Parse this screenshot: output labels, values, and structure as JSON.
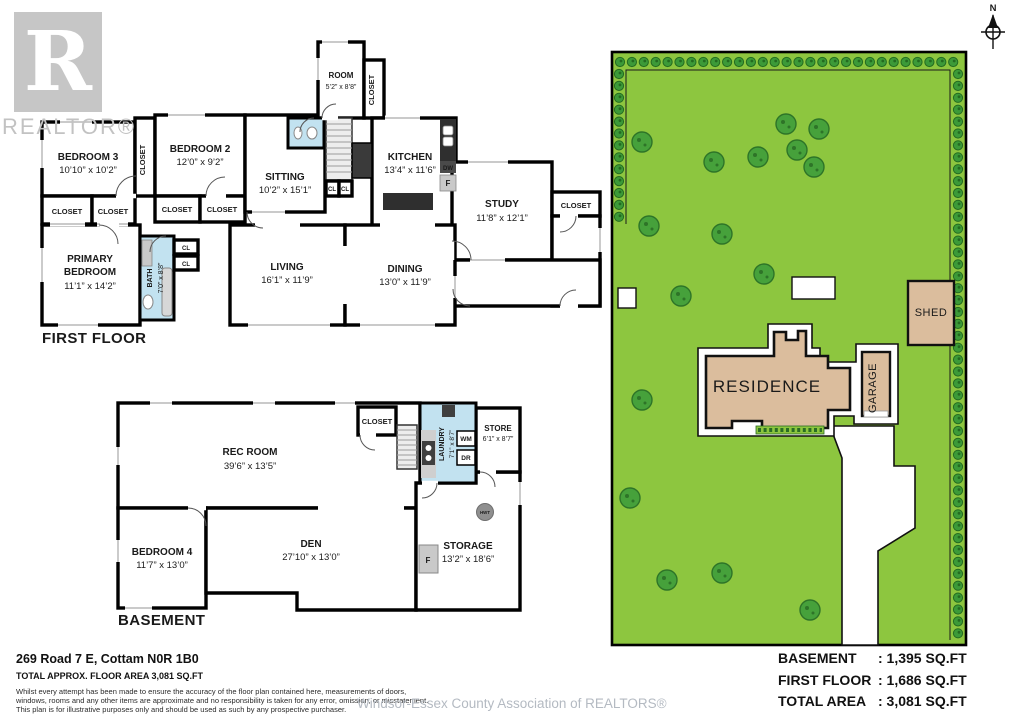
{
  "watermarks": {
    "logo_letter": "R",
    "logo_caption": "REALTOR®",
    "association": "Windsor-Essex County Association of REALTORS®"
  },
  "compass": {
    "label": "N"
  },
  "site": {
    "residence_label": "RESIDENCE",
    "garage_label": "GARAGE",
    "shed_label": "SHED",
    "colors": {
      "lot": "#8DC63F",
      "tree": "#46A13B",
      "hedge": "#3C9A38",
      "building": "#DBBD9D"
    },
    "trees": [
      [
        642,
        142
      ],
      [
        714,
        162
      ],
      [
        758,
        157
      ],
      [
        786,
        124
      ],
      [
        819,
        129
      ],
      [
        797,
        150
      ],
      [
        814,
        167
      ],
      [
        649,
        226
      ],
      [
        722,
        234
      ],
      [
        764,
        274
      ],
      [
        681,
        296
      ],
      [
        642,
        400
      ],
      [
        630,
        498
      ],
      [
        667,
        580
      ],
      [
        722,
        573
      ],
      [
        810,
        610
      ]
    ],
    "hedgerows": [
      {
        "x": 620,
        "y": 62,
        "dx": 11.9,
        "dy": 0,
        "count": 29
      },
      {
        "x": 958,
        "y": 74,
        "dx": 0,
        "dy": 11.9,
        "count": 48
      },
      {
        "x": 619,
        "y": 74,
        "dx": 0,
        "dy": 11.9,
        "count": 13
      }
    ]
  },
  "first_floor": {
    "plan_label": "FIRST FLOOR",
    "bedroom3": {
      "name": "BEDROOM 3",
      "dims": "10’10” x 10’2”"
    },
    "bedroom2": {
      "name": "BEDROOM 2",
      "dims": "12’0” x 9’2”"
    },
    "sitting": {
      "name": "SITTING",
      "dims": "10’2” x 15’1”"
    },
    "room": {
      "name": "ROOM",
      "dims": "5’2” x 8’8”"
    },
    "kitchen": {
      "name": "KITCHEN",
      "dims": "13’4” x 11’6”"
    },
    "study": {
      "name": "STUDY",
      "dims": "11’8” x 12’1”"
    },
    "living": {
      "name": "LIVING",
      "dims": "16’1” x 11’9”"
    },
    "dining": {
      "name": "DINING",
      "dims": "13’0” x 11’9”"
    },
    "primary": {
      "line1": "PRIMARY",
      "line2": "BEDROOM",
      "dims": "11’1” x 14’2”"
    },
    "bath": {
      "name": "BATH",
      "dims": "7’0” x 8’8”"
    },
    "closet": "CLOSET",
    "cl": "CL",
    "dw": "DW",
    "fridge": "F"
  },
  "basement": {
    "plan_label": "BASEMENT",
    "rec": {
      "name": "REC ROOM",
      "dims": "39’6” x 13’5”"
    },
    "bedroom4": {
      "name": "BEDROOM 4",
      "dims": "11’7” x 13’0”"
    },
    "den": {
      "name": "DEN",
      "dims": "27’10” x 13’0”"
    },
    "storage": {
      "name": "STORAGE",
      "dims": "13’2” x 18’6”"
    },
    "laundry": {
      "name": "LAUNDRY",
      "dims": "7’1” x 8’7”"
    },
    "store": {
      "name": "STORE",
      "dims": "6’1” x 8’7”"
    },
    "closet": "CLOSET",
    "wm": "WM",
    "dr": "DR",
    "fridge": "F",
    "hwt": "HWT"
  },
  "footer": {
    "address": "269 Road 7 E, Cottam N0R 1B0",
    "total_area_line": "TOTAL APPROX. FLOOR AREA 3,081 SQ.FT",
    "disclaimer1": "Whilst every attempt has been made to ensure the accuracy of the floor plan contained here, measurements of doors,",
    "disclaimer2": "windows, rooms and any other items are approximate and no responsibility is taken for any error, omission, or misstatement.",
    "disclaimer3": "This plan is for illustrative purposes only and should be used as such by any prospective purchaser.",
    "areas": [
      {
        "label": "BASEMENT",
        "value": ": 1,395 SQ.FT"
      },
      {
        "label": "FIRST FLOOR",
        "value": ": 1,686 SQ.FT"
      },
      {
        "label": "TOTAL AREA",
        "value": ": 3,081 SQ.FT"
      }
    ]
  }
}
